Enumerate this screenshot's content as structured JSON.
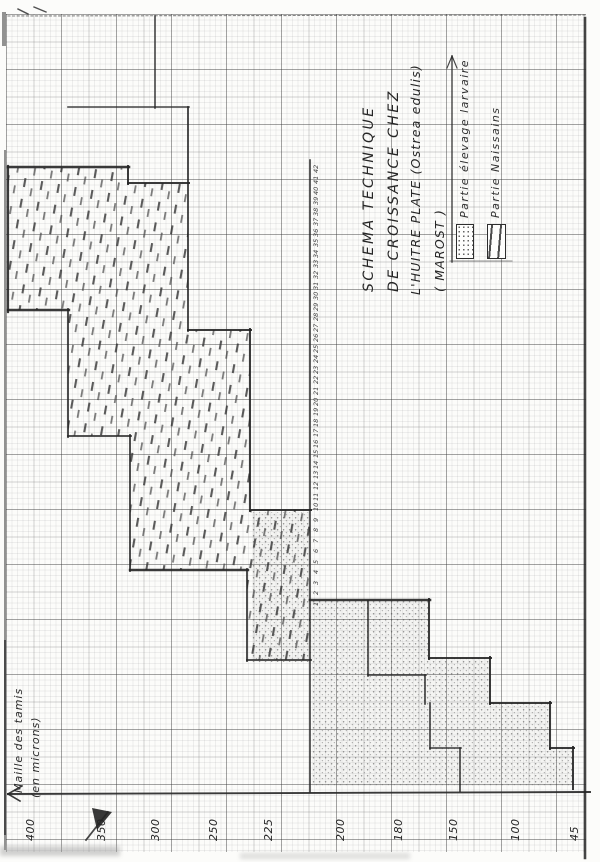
{
  "title": {
    "lines": [
      "SCHEMA TECHNIQUE",
      "DE CROISSANCE CHEZ",
      "L'HUITRE PLATE (Ostrea edulis)",
      "( MAROST )"
    ]
  },
  "legend": {
    "items": [
      {
        "label": "Partie élevage larvaire",
        "swatch": "stipple"
      },
      {
        "label": "Partie Naissains",
        "swatch": "dashes"
      }
    ]
  },
  "y_axis": {
    "title_line1": "Maille des tamis",
    "title_line2": "(en microns)",
    "ticks": [
      "400",
      "350",
      "300",
      "250",
      "225",
      "200",
      "180",
      "150",
      "100",
      "45"
    ]
  },
  "day_scale": {
    "numbers": [
      1,
      2,
      3,
      4,
      5,
      6,
      7,
      8,
      9,
      10,
      11,
      12,
      13,
      14,
      15,
      16,
      17,
      18,
      19,
      20,
      21,
      22,
      23,
      24,
      25,
      26,
      27,
      28,
      29,
      30,
      31,
      32,
      33,
      34,
      35,
      36,
      37,
      38,
      39,
      40,
      41,
      42
    ]
  },
  "colors": {
    "ink": "#262626",
    "paper": "#fcfcfa",
    "grid_heavy": "#5c5c5c",
    "grid_medium": "#8a8a8a",
    "grid_light": "#c9c9c9"
  },
  "chart_data": {
    "type": "area",
    "title": "SCHEMA TECHNIQUE DE CROISSANCE CHEZ L'HUITRE PLATE (Ostrea edulis) (MAROST)",
    "ylabel": "Maille des tamis (en microns)",
    "xlabel": "jours (échelle manuscrite le long de la ligne de phase)",
    "y_ticks": [
      400,
      350,
      300,
      250,
      225,
      200,
      180,
      150,
      100,
      45
    ],
    "x_day_numbers_range": [
      1,
      42
    ],
    "orientation": "scan tourné de 90° : l'axe des mailles se lit le long du bord gauche du papier",
    "estimated": true,
    "series": [
      {
        "name": "Partie élevage larvaire",
        "fill": "stipple",
        "mesh_steps_um": [
          45,
          67,
          120,
          144,
          163,
          190,
          210,
          233
        ]
      },
      {
        "name": "Partie Naissains",
        "fill": "dashes",
        "mesh_steps_um": [
          210,
          233,
          235,
          272,
          323,
          325,
          373,
          416
        ]
      }
    ],
    "outer_boundary_t_mesh": [
      [
        -17,
        45
      ],
      [
        -13,
        45
      ],
      [
        -13,
        67
      ],
      [
        -9,
        67
      ],
      [
        -9,
        120
      ],
      [
        -4,
        120
      ],
      [
        -4,
        163
      ],
      [
        1,
        163
      ],
      [
        1,
        210
      ],
      [
        10,
        210
      ],
      [
        10,
        233
      ],
      [
        27,
        233
      ],
      [
        27,
        272
      ],
      [
        41,
        272
      ],
      [
        41,
        325
      ],
      [
        42,
        325
      ],
      [
        42,
        416
      ]
    ],
    "inner_boundary_t_mesh": [
      [
        -17,
        210
      ],
      [
        -5,
        210
      ],
      [
        -5,
        235
      ],
      [
        4,
        235
      ],
      [
        4,
        323
      ],
      [
        17,
        323
      ],
      [
        17,
        373
      ],
      [
        29,
        373
      ],
      [
        29,
        416
      ]
    ],
    "tail_inner_boundary_t_mesh": [
      [
        -17,
        144
      ],
      [
        -13,
        144
      ],
      [
        -13,
        162
      ],
      [
        -9,
        165
      ],
      [
        -6,
        165
      ],
      [
        -6,
        190
      ],
      [
        1,
        190
      ]
    ]
  }
}
